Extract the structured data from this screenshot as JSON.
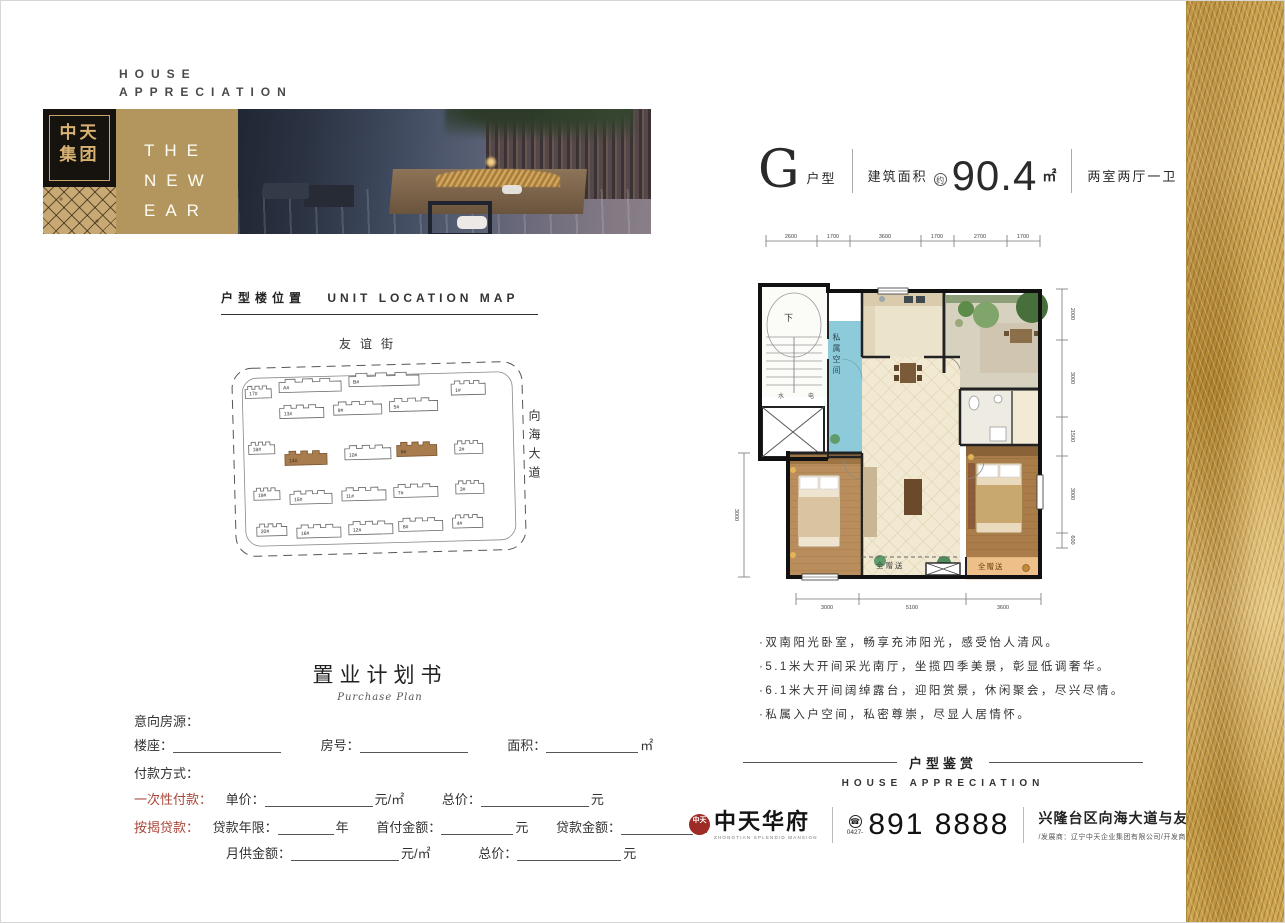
{
  "header": {
    "line1": "HOUSE",
    "line2": "APPRECIATION"
  },
  "logo": {
    "char_line1": "中天",
    "char_line2": "集团"
  },
  "banner": {
    "lines": [
      "THE",
      "NEW",
      "EAR"
    ]
  },
  "unit_header": {
    "letter": "G",
    "type_label": "户型",
    "area_label": "建筑面积",
    "approx": "约",
    "area_value": "90.4",
    "area_unit": "㎡",
    "rooms": "两室两厅一卫"
  },
  "location_map": {
    "title_cn": "户型楼位置",
    "title_en": "UNIT LOCATION MAP",
    "street_top": "友谊街",
    "road_right": "向海大道",
    "building_labels": [
      "17#",
      "A#",
      "B#",
      "1#",
      "13#",
      "9#",
      "5#",
      "18#",
      "14#",
      "10#",
      "6#",
      "2#",
      "19#",
      "15#",
      "11#",
      "7#",
      "3#",
      "20#",
      "16#",
      "12#",
      "8#",
      "4#"
    ],
    "highlighted": [
      "14#",
      "6#"
    ],
    "highlight_color": "#a97c4e"
  },
  "floorplan": {
    "dims_top": [
      "2600",
      "1700",
      "3600",
      "1700",
      "2700",
      "1700"
    ],
    "dims_right": [
      "2000",
      "3000",
      "1500",
      "3000",
      "600"
    ],
    "dims_bottom": [
      "3000",
      "5100",
      "3600"
    ],
    "dims_left": [
      "3000"
    ],
    "label_down": "下",
    "label_water": "水",
    "label_elec": "电",
    "label_private": "私属空间",
    "label_gift_center": "全赠送",
    "label_gift_right": "全赠送"
  },
  "features": {
    "bullets": [
      "·双南阳光卧室，畅享充沛阳光，感受怡人清风。",
      "·5.1米大开间采光南厅，坐揽四季美景，彰显低调奢华。",
      "·6.1米大开间阔绰露台，迎阳赏景，休闲聚会，尽兴尽情。",
      "·私属入户空间，私密尊崇，尽显人居情怀。"
    ]
  },
  "appreciation": {
    "cn": "户型鉴赏",
    "en": "HOUSE APPRECIATION"
  },
  "form": {
    "title": "置业计划书",
    "subtitle": "Purchase Plan",
    "intent_label": "意向房源：",
    "building_label": "楼座：",
    "room_label": "房号：",
    "area_label": "面积：",
    "area_unit": "㎡",
    "payment_label": "付款方式：",
    "onetime_label": "一次性付款：",
    "unit_price_label": "单价：",
    "per_sqm_unit": "元/㎡",
    "total_label": "总价：",
    "yuan_unit": "元",
    "mortgage_label": "按揭贷款：",
    "loan_years_label": "贷款年限：",
    "year_unit": "年",
    "down_payment_label": "首付金额：",
    "loan_amount_label": "贷款金额：",
    "monthly_label": "月供金额："
  },
  "contact": {
    "seal_text": "中天",
    "brand": "中天华府",
    "brand_en": "ZHONGTIAN SPLENDID MANSION",
    "phone_icon": "☎",
    "area_code": "0427-",
    "phone": "891 8888",
    "address": "兴隆台区向海大道与友谊街交会处",
    "developers": "/发展商：辽宁中天企业集团有限公司/开发商：盘锦中天置业有限公司"
  }
}
